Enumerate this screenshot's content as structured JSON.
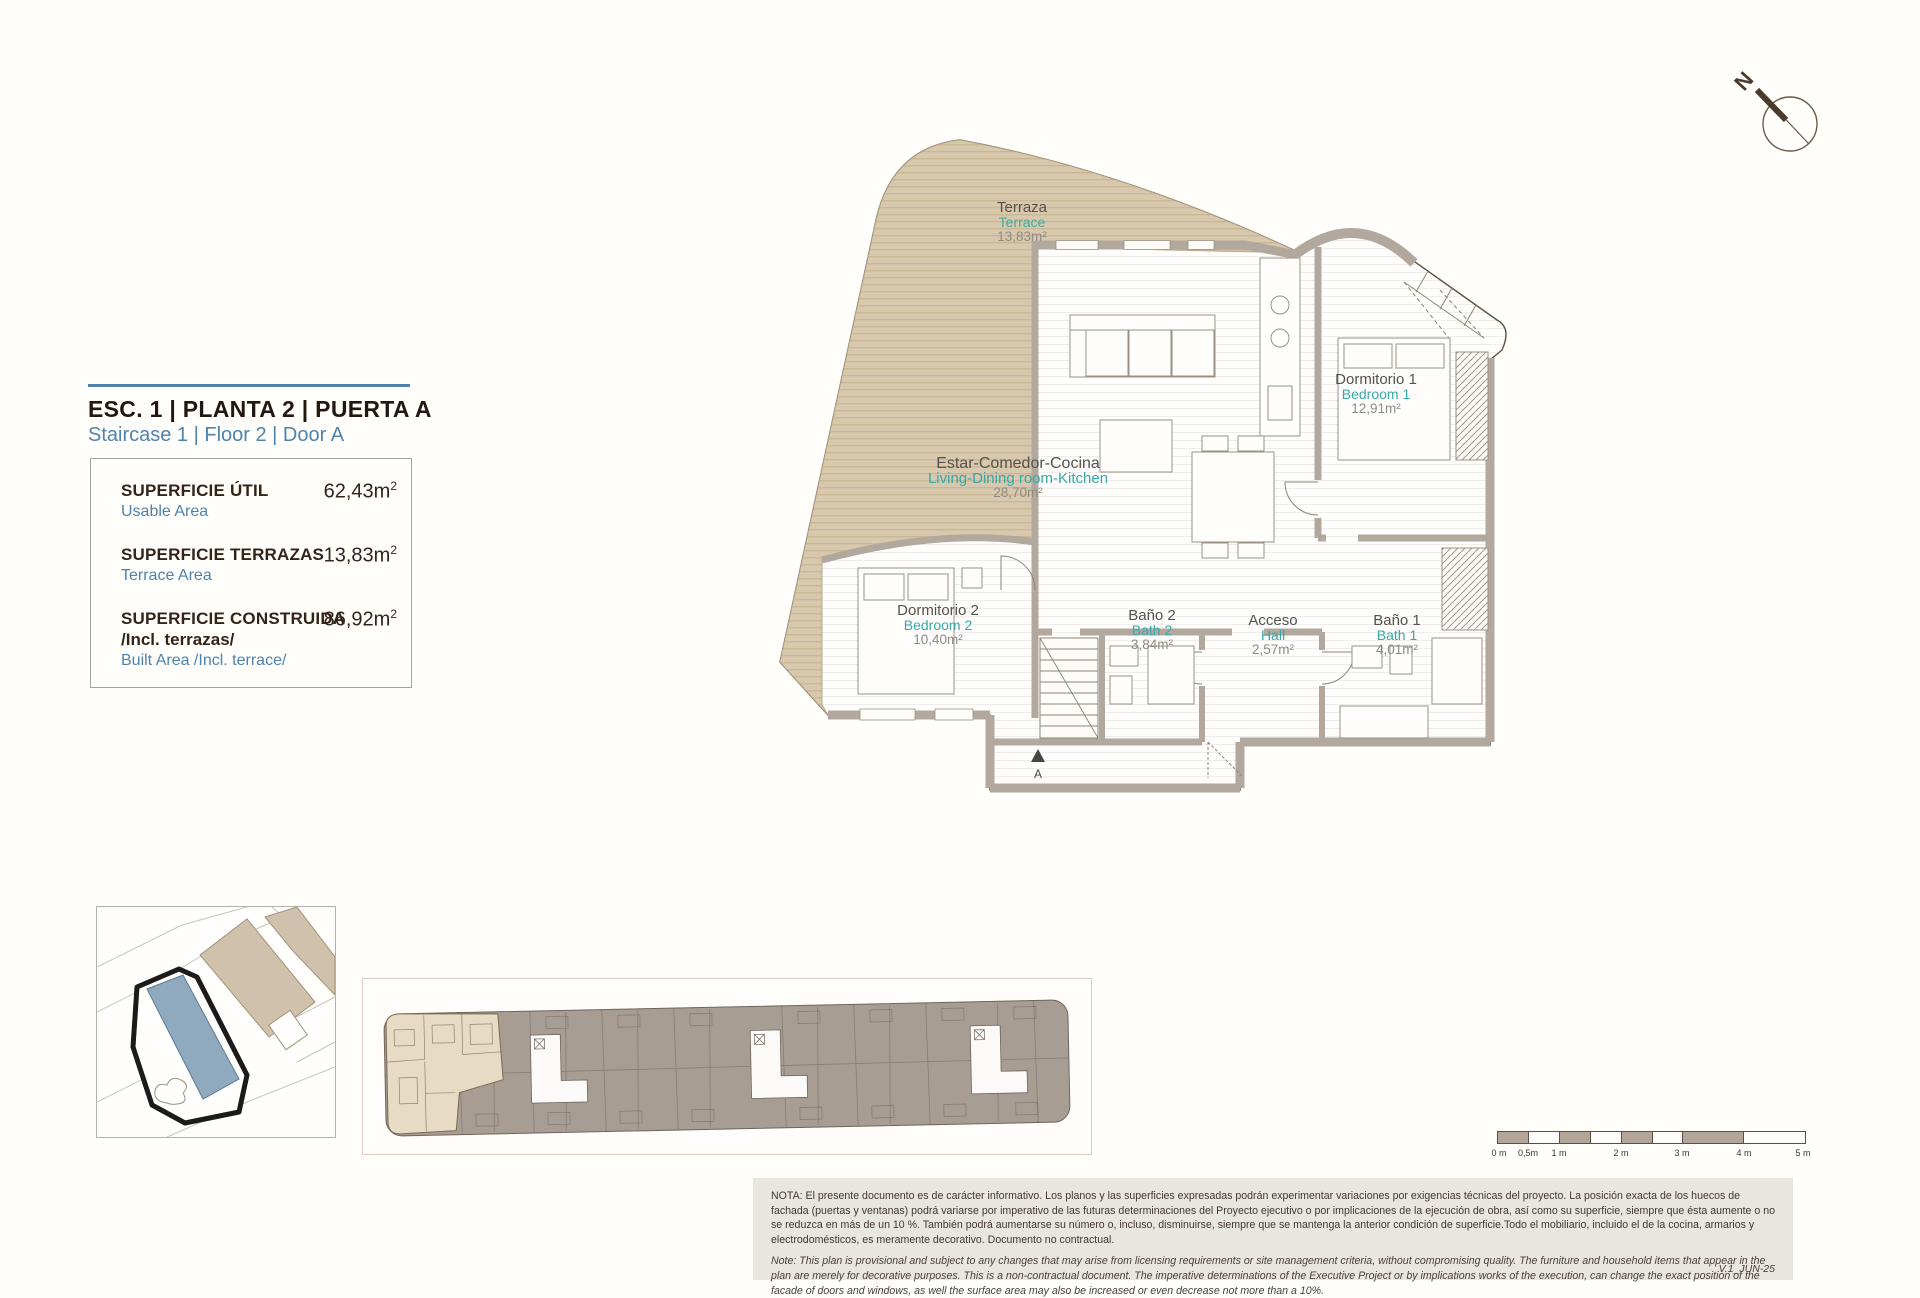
{
  "header": {
    "compass_label": "N"
  },
  "title_block": {
    "title": "ESC. 1 | PLANTA 2 | PUERTA A",
    "subtitle": "Staircase 1 | Floor 2 | Door A"
  },
  "area_table": {
    "rows": [
      {
        "label": "SUPERFICIE ÚTIL",
        "label2": "",
        "sublabel": "Usable Area",
        "value": "62,43",
        "unit_base": "m",
        "unit_sup": "2"
      },
      {
        "label": "SUPERFICIE TERRAZAS",
        "label2": "",
        "sublabel": "Terrace Area",
        "value": "13,83",
        "unit_base": "m",
        "unit_sup": "2"
      },
      {
        "label": "SUPERFICIE CONSTRUIDA",
        "label2": "/Incl. terrazas/",
        "sublabel": "Built Area /Incl. terrace/",
        "value": "86,92",
        "unit_base": "m",
        "unit_sup": "2"
      }
    ]
  },
  "floor_plan": {
    "rooms": [
      {
        "name_es": "Terraza",
        "name_en": "Terrace",
        "area": "13,83m²"
      },
      {
        "name_es": "Estar-Comedor-Cocina",
        "name_en": "Living-Dining room-Kitchen",
        "area": "28,70m²"
      },
      {
        "name_es": "Dormitorio 1",
        "name_en": "Bedroom 1",
        "area": "12,91m²"
      },
      {
        "name_es": "Dormitorio 2",
        "name_en": "Bedroom 2",
        "area": "10,40m²"
      },
      {
        "name_es": "Baño 2",
        "name_en": "Bath 2",
        "area": "3,84m²"
      },
      {
        "name_es": "Acceso",
        "name_en": "Hall",
        "area": "2,57m²"
      },
      {
        "name_es": "Baño 1",
        "name_en": "Bath 1",
        "area": "4,01m²"
      }
    ],
    "entrance_label": "A"
  },
  "scale_bar": {
    "labels": [
      "0 m",
      "0,5m",
      "1 m",
      "2 m",
      "3 m",
      "4 m",
      "5 m"
    ]
  },
  "notes": {
    "es": "NOTA:  El presente documento es de carácter informativo. Los planos y las superficies expresadas podrán experimentar variaciones por exigencias técnicas del proyecto. La posición exacta de los huecos de fachada (puertas y ventanas) podrá variarse por imperativo de las futuras determinaciones del Proyecto ejecutivo o por implicaciones de la ejecución de obra, así como su superficie, siempre que ésta aumente o no se reduzca en más de un 10 %. También podrá aumentarse su número o, incluso, disminuirse, siempre que se mantenga la anterior condición de superficie.Todo el mobiliario, incluido el de la cocina, armarios y electrodomésticos, es meramente decorativo. Documento no contractual.",
    "en": "Note: This plan is provisional and subject to any changes that may arise from licensing requirements or site management criteria, without compromising quality. The furniture and household items that appear in the plan are merely for decorative purposes. This is a non-contractual document. The imperative determinations of the Executive Project or by implications works of the execution, can change the exact position of the facade of doors and windows, as well the surface area may also be increased or even decrease not more than a 10%.",
    "version": "V.1_JUN-25"
  },
  "colors": {
    "accent_blue": "#4d83ad",
    "teal": "#35a8aa",
    "terrace_beige": "#d8c8ae",
    "wall_gray": "#b2a89d",
    "site_highlight": "#8fa9bf"
  }
}
